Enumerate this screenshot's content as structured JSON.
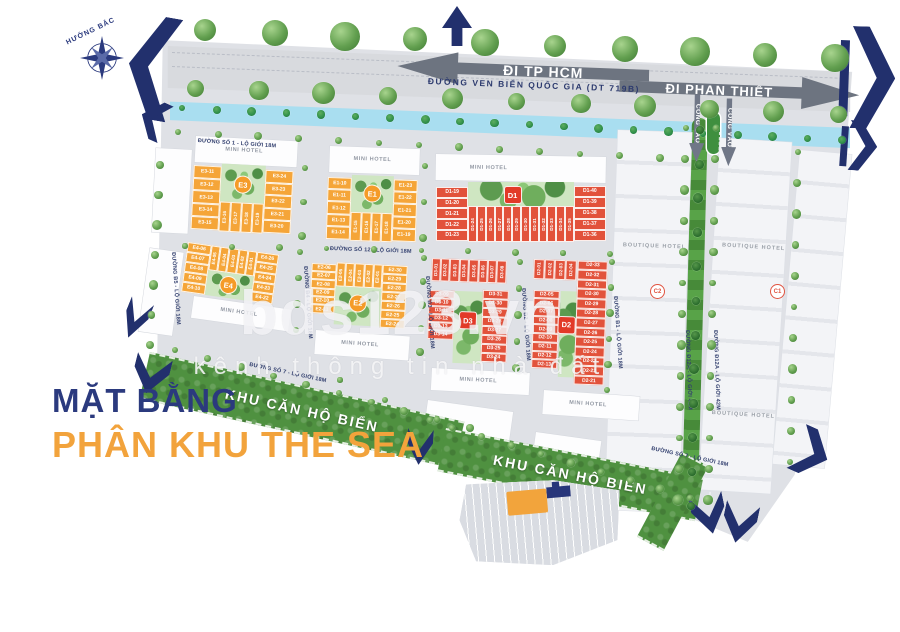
{
  "title": {
    "line1": "MẶT BẰNG",
    "line2": "PHÂN KHU THE SEA"
  },
  "compass": {
    "label": "HƯỚNG BẮC"
  },
  "top_road": {
    "name": "ĐƯỜNG VEN BIỂN QUỐC GIA (DT 719B)",
    "dir_left": "ĐI TP HCM",
    "dir_right": "ĐI PHAN THIẾT"
  },
  "gate": {
    "label": "CỔNG VÀO"
  },
  "watermark": {
    "brand": "bds123.vn",
    "tagline": "kênh thông tin nhà đất"
  },
  "beach_strip": {
    "label": "KHU CĂN HỘ BIỂN"
  },
  "roads": {
    "so1": "ĐƯỜNG SỐ 1 - LỘ GIỚI 18M",
    "so12": "ĐƯỜNG SỐ 12 - LỘ GIỚI 18M",
    "so7": "ĐƯỜNG SỐ 7 - LỘ GIỚI 18M",
    "b5": "ĐƯỜNG B5 - LỘ GIỚI 18M",
    "b4": "ĐƯỜNG B4 - LỘ GIỚI 18M",
    "b3": "ĐƯỜNG B3 - LỘ GIỚI 18M",
    "b2": "ĐƯỜNG B2 - LỘ GIỚI 18M",
    "b1": "ĐƯỜNG B1 - LỘ GIỚI 18M",
    "d12a": "ĐƯỜNG Đ12A - LỘ GIỚI 42M"
  },
  "hotels": {
    "mini": "MINI HOTEL",
    "boutique": "BOUTIQUE HOTEL"
  },
  "towers": {
    "c1": "C1",
    "c2": "C2"
  },
  "colors": {
    "navy": "#22306d",
    "orange": "#f5a538",
    "red": "#e2523b",
    "orange_badge": "#f59b28",
    "red_badge": "#e23a28",
    "water": "#a9def0",
    "green_strip": "#4f9140",
    "park": "#cfe6c2",
    "road": "#d8dade",
    "ground": "#dfe1e6"
  },
  "blocks": {
    "E3": {
      "label": "E3",
      "palette": "orange",
      "lots": {
        "left": [
          "E3-11",
          "E3-12",
          "E3-13",
          "E3-14",
          "E3-15"
        ],
        "midv": [
          "E3-16",
          "E3-17",
          "E3-18",
          "E3-19"
        ],
        "right": [
          "E3-24",
          "E3-23",
          "E3-22",
          "E3-21",
          "E3-20"
        ]
      }
    },
    "E1": {
      "label": "E1",
      "palette": "orange",
      "lots": {
        "left": [
          "E1-10",
          "E1-11",
          "E1-12",
          "E1-13",
          "E1-14"
        ],
        "midv": [
          "E1-15",
          "E1-16",
          "E1-17",
          "E1-18"
        ],
        "right": [
          "E1-23",
          "E1-22",
          "E1-21",
          "E1-20",
          "E1-19"
        ]
      }
    },
    "D1": {
      "label": "D1",
      "palette": "red",
      "lots": {
        "left": [
          "D1-19",
          "D1-20",
          "D1-21",
          "D1-22",
          "D1-23"
        ],
        "midv": [
          "D1-24",
          "D1-25",
          "D1-26",
          "D1-27",
          "D1-28",
          "D1-29",
          "D1-30",
          "D1-31",
          "D1-32",
          "D1-33",
          "D1-34",
          "D1-35"
        ],
        "right": [
          "D1-40",
          "D1-39",
          "D1-38",
          "D1-37",
          "D1-36"
        ]
      }
    },
    "E4": {
      "label": "E4",
      "palette": "orange",
      "lots": {
        "left": [
          "E4-06",
          "E4-07",
          "E4-08",
          "E4-09",
          "E4-10"
        ],
        "midv": [
          "E4-05",
          "E4-04",
          "E4-03",
          "E4-02",
          "E4-01"
        ],
        "right": [
          "E4-26",
          "E4-25",
          "E4-24",
          "E4-23",
          "E4-22"
        ]
      }
    },
    "E2": {
      "label": "E2",
      "palette": "orange",
      "lots": {
        "left": [
          "E2-06",
          "E2-07",
          "E2-08",
          "E2-09",
          "E2-10",
          "E2-11"
        ],
        "midv": [
          "E2-05",
          "E2-04",
          "E2-03",
          "E2-02",
          "E2-01"
        ],
        "right": [
          "E2-30",
          "E2-29",
          "E2-28",
          "E2-27",
          "E2-26",
          "E2-25",
          "E2-24"
        ]
      }
    },
    "D3": {
      "label": "D3",
      "palette": "red",
      "lots": {
        "midv": [
          "D3-01",
          "D3-02",
          "D3-03",
          "D3-04",
          "D3-05",
          "D3-06",
          "D3-07",
          "D3-08"
        ],
        "left": [
          "D3-09",
          "D3-10",
          "D3-11",
          "D3-12",
          "D3-13",
          "D3-14"
        ],
        "right": [
          "D3-31",
          "D3-30",
          "D3-29",
          "D3-28",
          "D3-27",
          "D3-26",
          "D3-25",
          "D3-24"
        ]
      }
    },
    "D2": {
      "label": "D2",
      "palette": "red",
      "lots": {
        "midv": [
          "D2-01",
          "D2-02",
          "D2-03",
          "D2-04"
        ],
        "left": [
          "D2-05",
          "D2-06",
          "D2-07",
          "D2-08",
          "D2-09",
          "D2-10",
          "D2-11",
          "D2-12",
          "D2-13"
        ],
        "right": [
          "D2-33",
          "D2-32",
          "D2-31",
          "D2-30",
          "D2-29",
          "D2-28",
          "D2-27",
          "D2-26",
          "D2-25",
          "D2-24",
          "D2-23",
          "D2-22",
          "D2-21"
        ]
      }
    }
  }
}
